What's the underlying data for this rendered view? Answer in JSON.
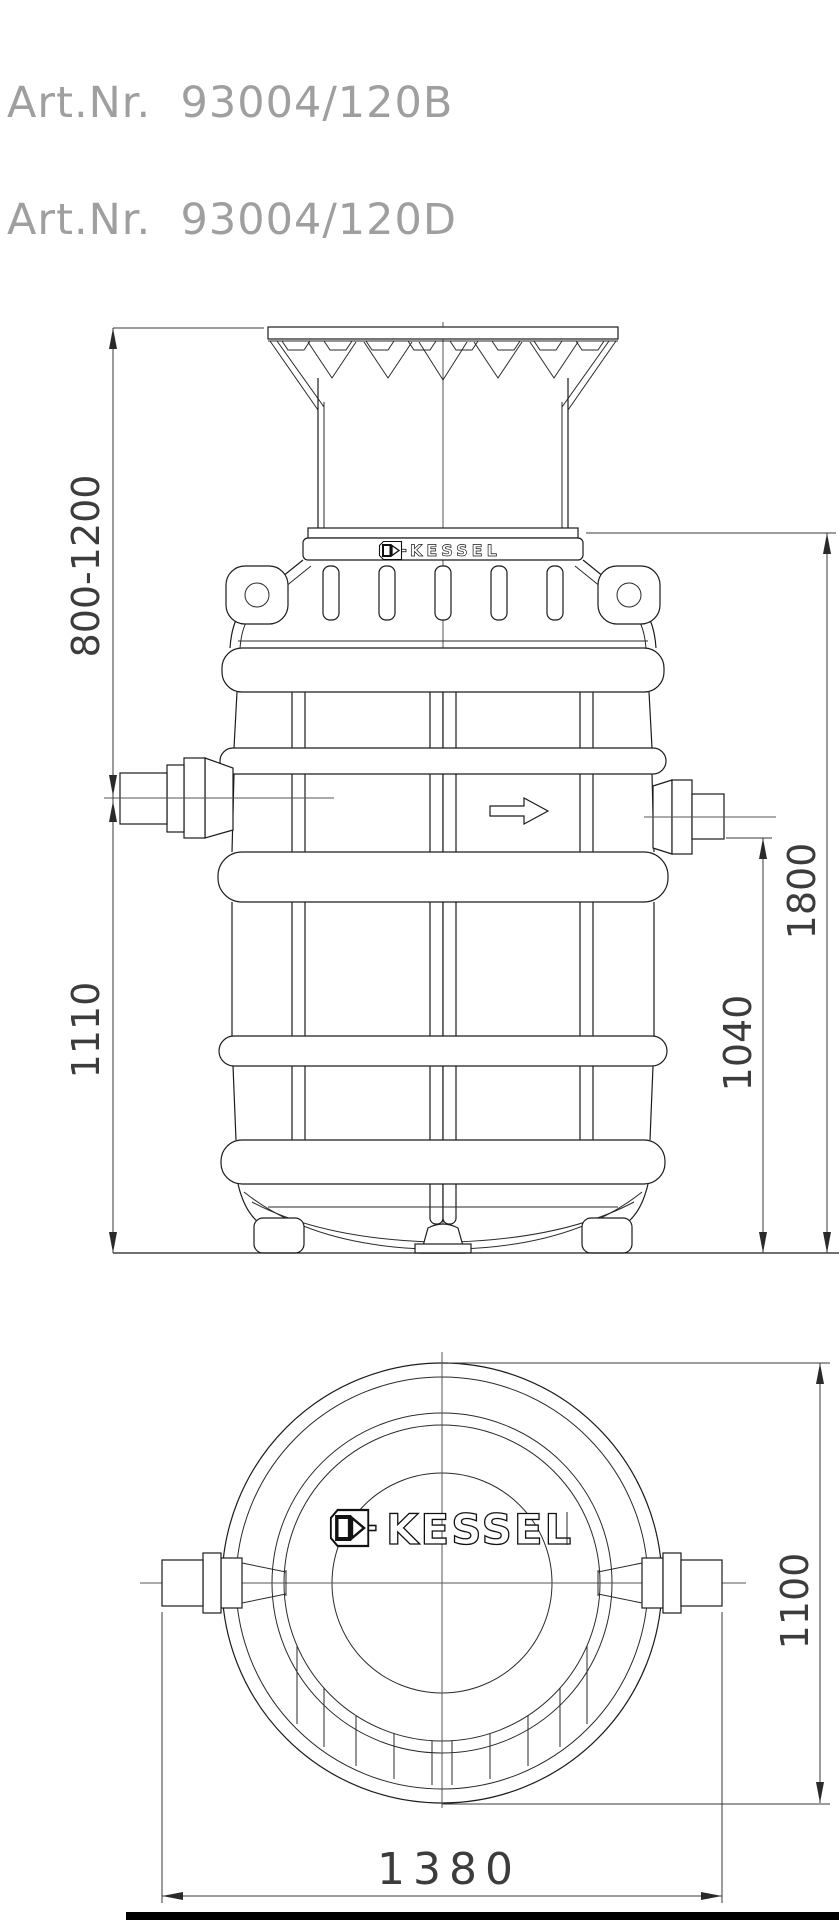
{
  "header": {
    "art_numbers": [
      "Art.Nr.  93004/120B",
      "Art.Nr.  93004/120D"
    ]
  },
  "brand": {
    "name": "KESSEL"
  },
  "drawing": {
    "side_view": {
      "dim_shaft_adjust_range": "800-1200",
      "dim_inlet_height": "1110",
      "dim_total_height": "1800",
      "dim_outlet_height": "1040"
    },
    "top_view": {
      "dim_tank_diameter": "1100",
      "dim_overall_width": "1380"
    }
  },
  "colors": {
    "line": "#1c1c1c",
    "dim_text": "#3c3c3c",
    "art_text": "#9f9f9f",
    "background": "#ffffff"
  }
}
